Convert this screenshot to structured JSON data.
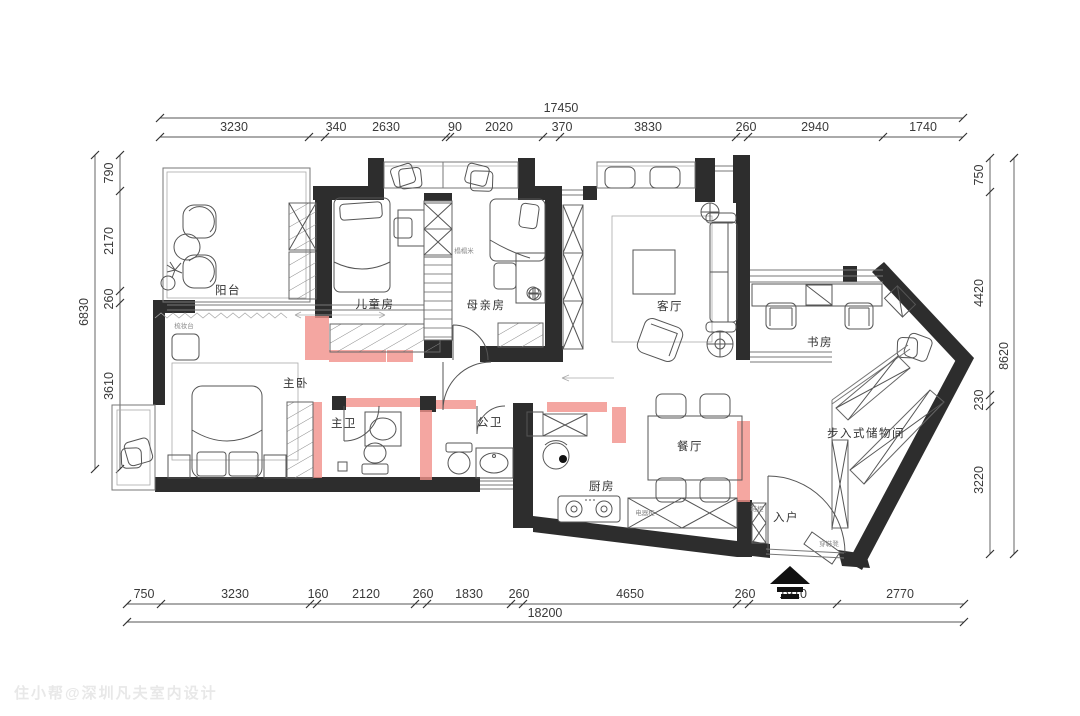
{
  "plan": {
    "watermark": "住小帮@深圳凡夫室内设计",
    "rooms": {
      "balcony": "阳台",
      "kids": "儿童房",
      "mother": "母亲房",
      "living": "客厅",
      "study": "书房",
      "master": "主卧",
      "master_bath": "主卫",
      "guest_bath": "公卫",
      "kitchen": "厨房",
      "dining": "餐厅",
      "storage": "步入式储物间",
      "entry": "入户"
    },
    "small_labels": {
      "dresser": "梳妆台",
      "tatami": "榻榻米",
      "appliance_cabinet": "电器柜",
      "shoe_cabinet": "鞋柜",
      "shoe_bench": "穿鞋凳"
    },
    "dims": {
      "top": {
        "total": "17450",
        "segments": [
          "3230",
          "340",
          "2630",
          "90",
          "2020",
          "370",
          "3830",
          "260",
          "2940",
          "1740"
        ]
      },
      "bottom": {
        "total": "18200",
        "segments": [
          "750",
          "3230",
          "160",
          "2120",
          "260",
          "1830",
          "260",
          "4650",
          "260",
          "1910",
          "2770"
        ]
      },
      "left": {
        "total": "6830",
        "segments": [
          "790",
          "2170",
          "260",
          "3610"
        ]
      },
      "right": {
        "total": "8620",
        "segments": [
          "750",
          "4420",
          "230",
          "3220"
        ]
      }
    },
    "colors": {
      "existing_wall": "#2d2d2d",
      "new_wall": "#f2918a",
      "dim_text": "#3a3a3a",
      "line": "#777777",
      "watermark": "#e8e8e8"
    }
  }
}
